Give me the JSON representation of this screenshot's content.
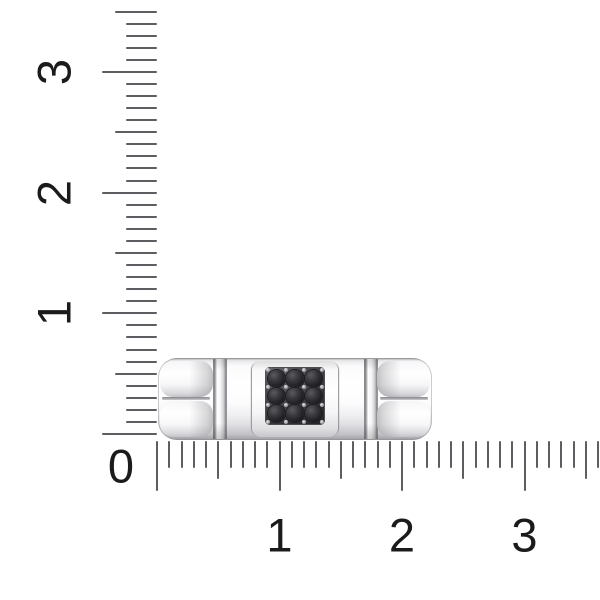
{
  "scene": {
    "type": "product-photo",
    "subject": "Polished white-metal ring band shown in side profile with a square 3x3 pave panel of round black stones, photographed to scale against centimeter rulers on a white background",
    "background_color": "#ffffff"
  },
  "rulers": {
    "origin_label": "0",
    "tick_color": "#5e5e62",
    "number_color": "#1b1b1d",
    "vertical": {
      "position": "left-edge",
      "numbers": [
        "3",
        "2",
        "1"
      ],
      "numbers_rotated_ccw": true,
      "minor_ticks_per_unit": 10,
      "extent_units": 3.5
    },
    "horizontal": {
      "position": "bottom-edge",
      "numbers": [
        "1",
        "2",
        "3"
      ],
      "minor_ticks_per_unit": 10,
      "extent_units": 3.6
    }
  },
  "ring": {
    "metal_highlight": "#ffffff",
    "metal_shadow": "#a9a9ad",
    "panel_color": "#3a3a3e",
    "stones": {
      "rows": 3,
      "cols": 3,
      "count": 9,
      "shape": "round",
      "color": "#212125"
    },
    "features": [
      "rounded end caps with horizontal center groove",
      "thin vertical polished ridges",
      "raised center plate holding black pave square"
    ]
  }
}
